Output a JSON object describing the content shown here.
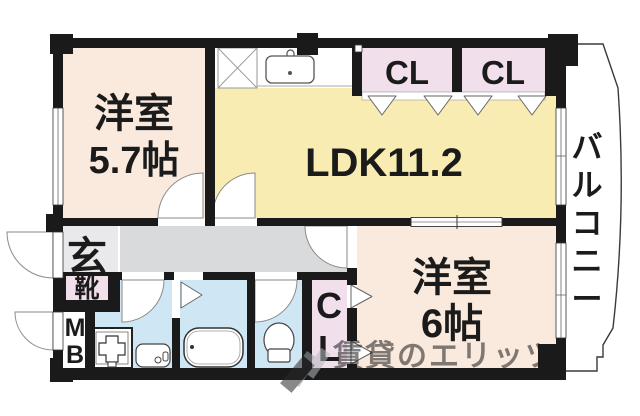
{
  "rooms": {
    "bedroom1": {
      "name": "洋室",
      "size": "5.7帖"
    },
    "bedroom2": {
      "name": "洋室",
      "size": "6帖"
    },
    "ldk": {
      "name": "LDK11.2"
    },
    "balcony": {
      "name": "バルコニー"
    },
    "entrance": {
      "name": "玄"
    },
    "shoe_box": {
      "name": "靴"
    },
    "meter_box": {
      "name": "MB"
    },
    "closet_upper_left": {
      "name": "CL"
    },
    "closet_upper_right": {
      "name": "CL"
    },
    "closet_lower": {
      "name": "CL"
    }
  },
  "watermark": {
    "text": "賃貸のエリッツ"
  },
  "colors": {
    "wall": "#1a1a1a",
    "room_peach": "#faeadd",
    "ldk_yellow": "#f8ecb2",
    "closet_pink": "#f2dfec",
    "wet_blue": "#cfe7f4",
    "hall_gray": "#d9dadc",
    "genkan_gray": "#e9e9eb",
    "watermark_gray": "#979ca1"
  }
}
